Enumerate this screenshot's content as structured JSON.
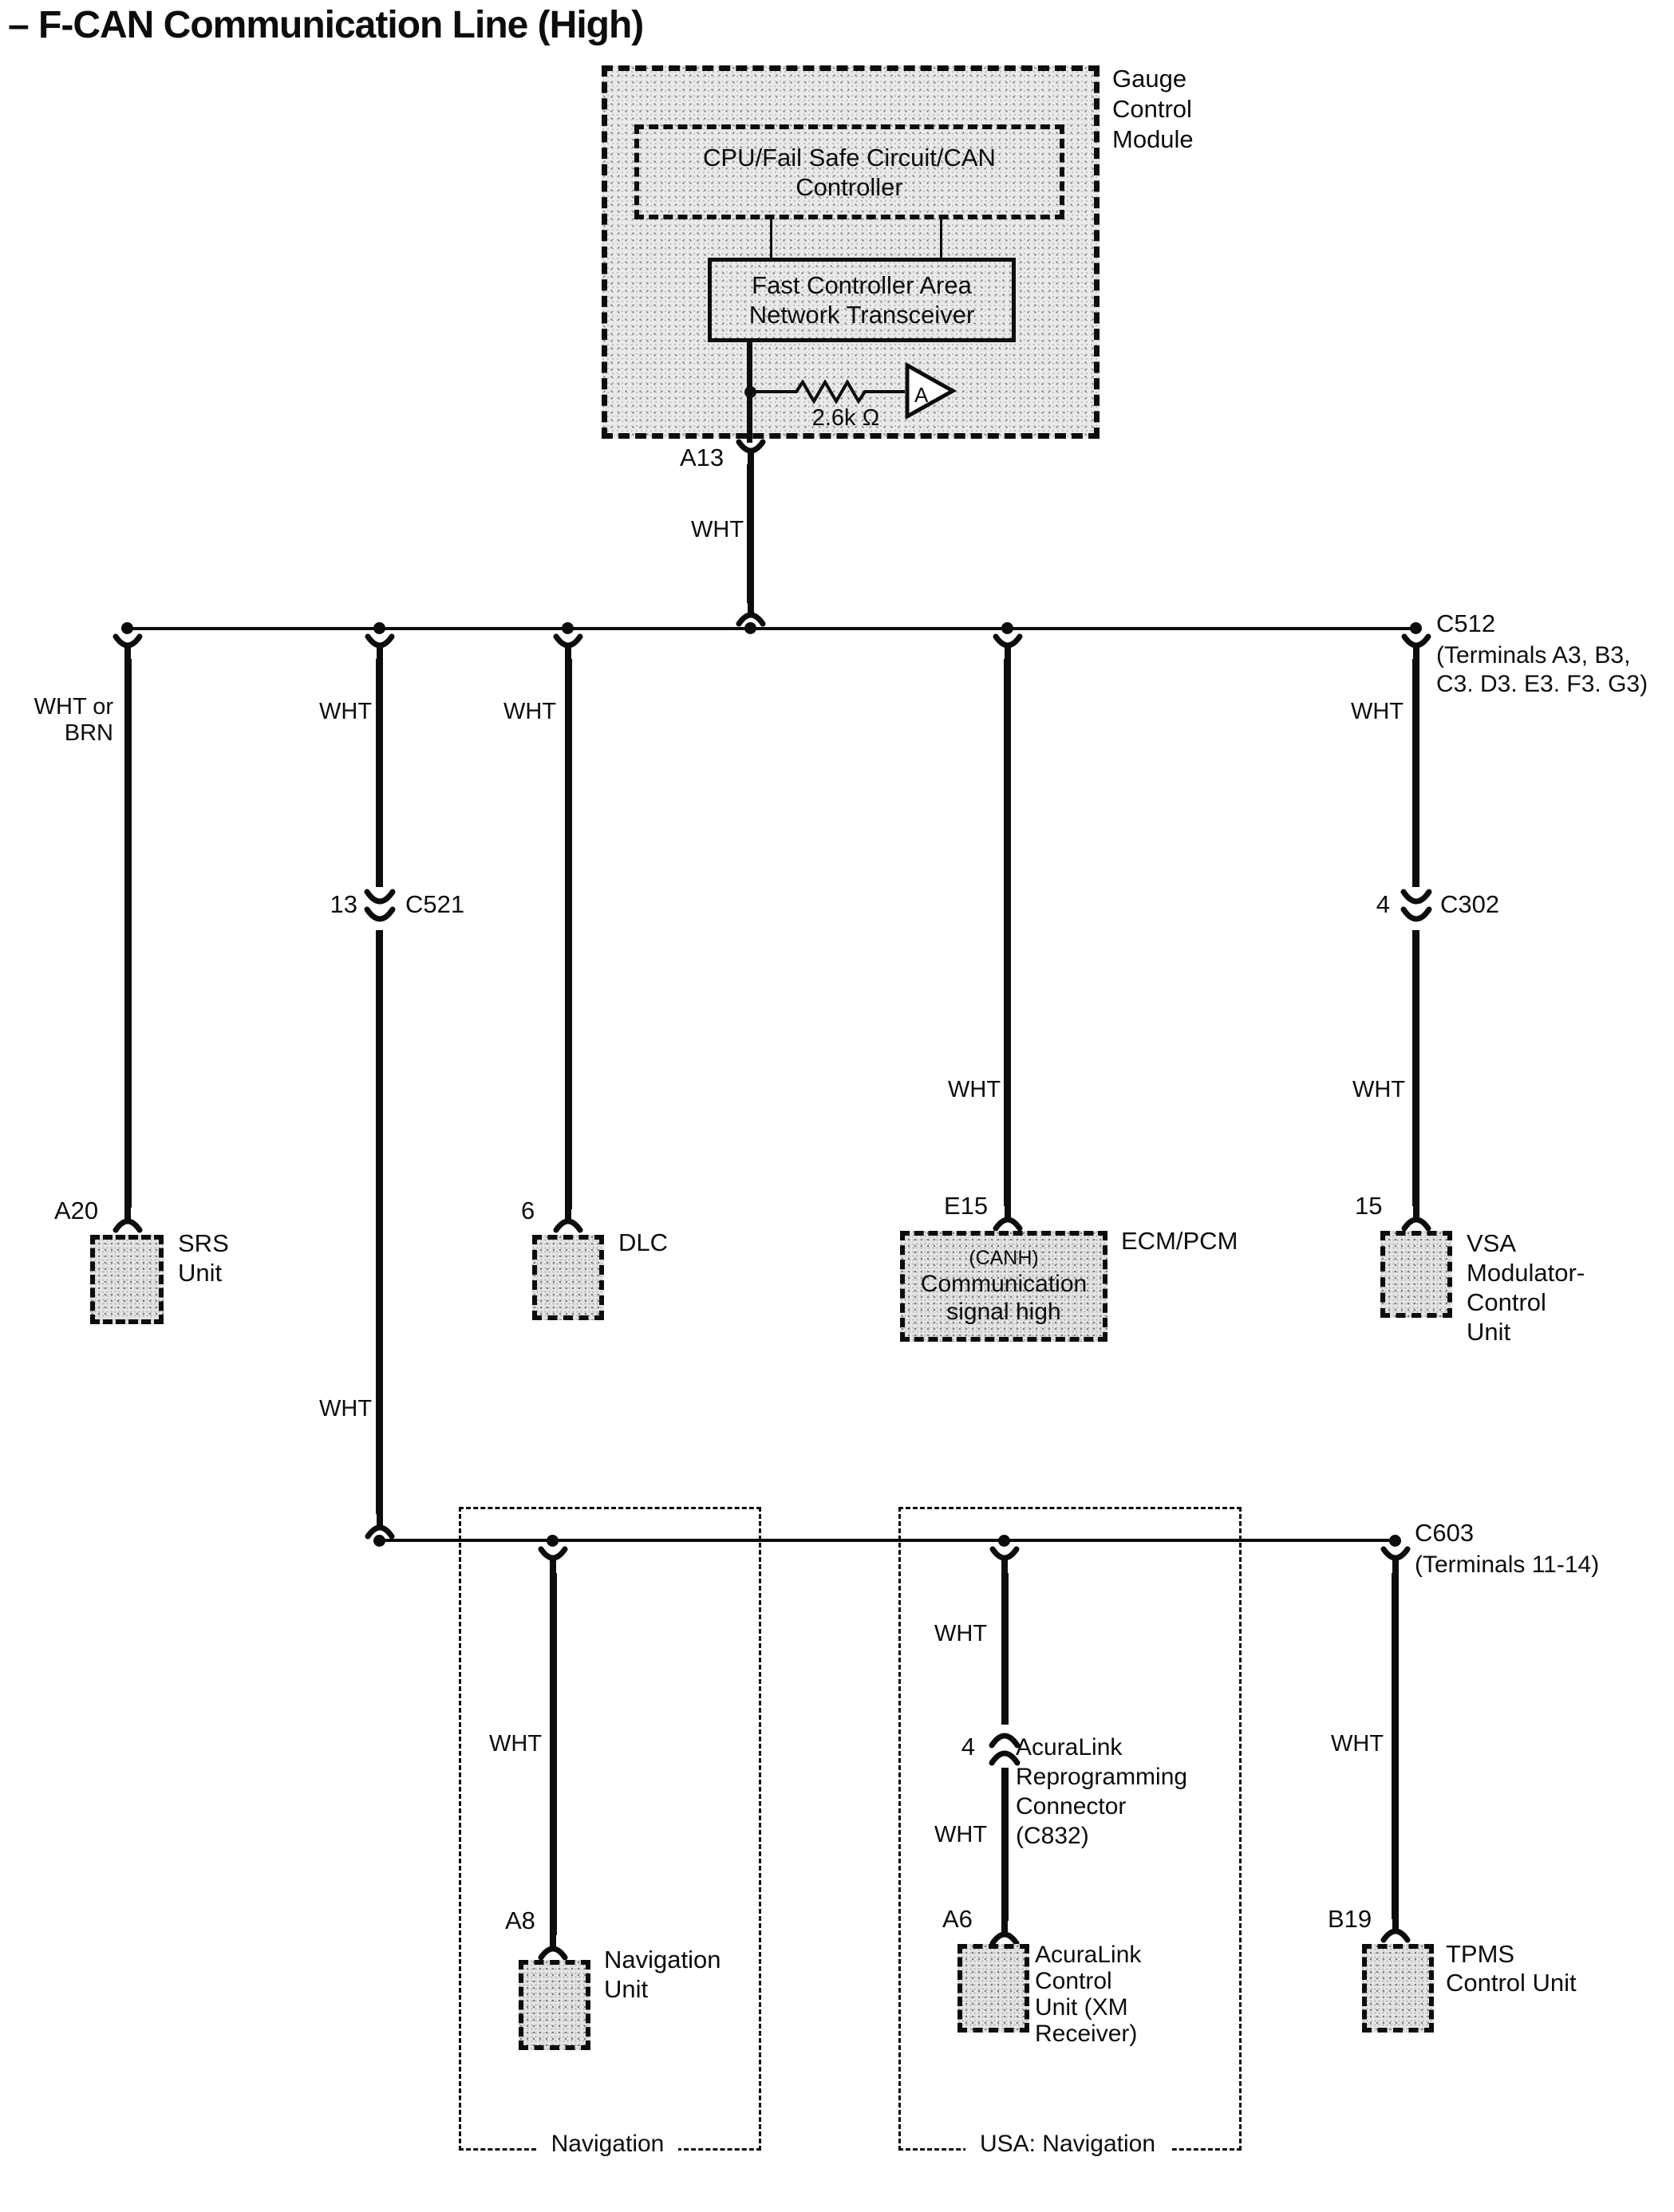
{
  "title": "– F-CAN Communication Line (High)",
  "gauge_module": {
    "label": "Gauge\nControl\nModule",
    "cpu_box": "CPU/Fail Safe Circuit/CAN\nController",
    "transceiver_box": "Fast Controller Area\nNetwork Transceiver",
    "resistor": "2.6k Ω",
    "amplifier": "A",
    "pin": "A13"
  },
  "wire_labels": {
    "wht": "WHT",
    "wht_or_brn": "WHT or\nBRN"
  },
  "connectors": {
    "c512": {
      "name": "C512",
      "terminals": "(Terminals A3, B3,\nC3. D3. E3. F3. G3)"
    },
    "c521": {
      "pin": "13",
      "name": "C521"
    },
    "c302": {
      "pin": "4",
      "name": "C302"
    },
    "c603": {
      "name": "C603",
      "terminals": "(Terminals 11-14)"
    },
    "c832": {
      "pin": "4",
      "label": "AcuraLink\nReprogramming\nConnector\n(C832)"
    }
  },
  "components": {
    "srs": {
      "pin": "A20",
      "label": "SRS\nUnit"
    },
    "dlc": {
      "pin": "6",
      "label": "DLC"
    },
    "ecm": {
      "pin": "E15",
      "canh": "(CANH)",
      "box_text": "Communication\nsignal high",
      "label": "ECM/PCM"
    },
    "vsa": {
      "pin": "15",
      "label": "VSA\nModulator-\nControl\nUnit"
    },
    "navigation_unit": {
      "pin": "A8",
      "label": "Navigation\nUnit"
    },
    "acuralink": {
      "pin": "A6",
      "label": "AcuraLink\nControl\nUnit (XM\nReceiver)"
    },
    "tpms": {
      "pin": "B19",
      "label": "TPMS\nControl Unit"
    }
  },
  "regions": {
    "navigation": "Navigation",
    "usa_navigation": "USA: Navigation"
  }
}
